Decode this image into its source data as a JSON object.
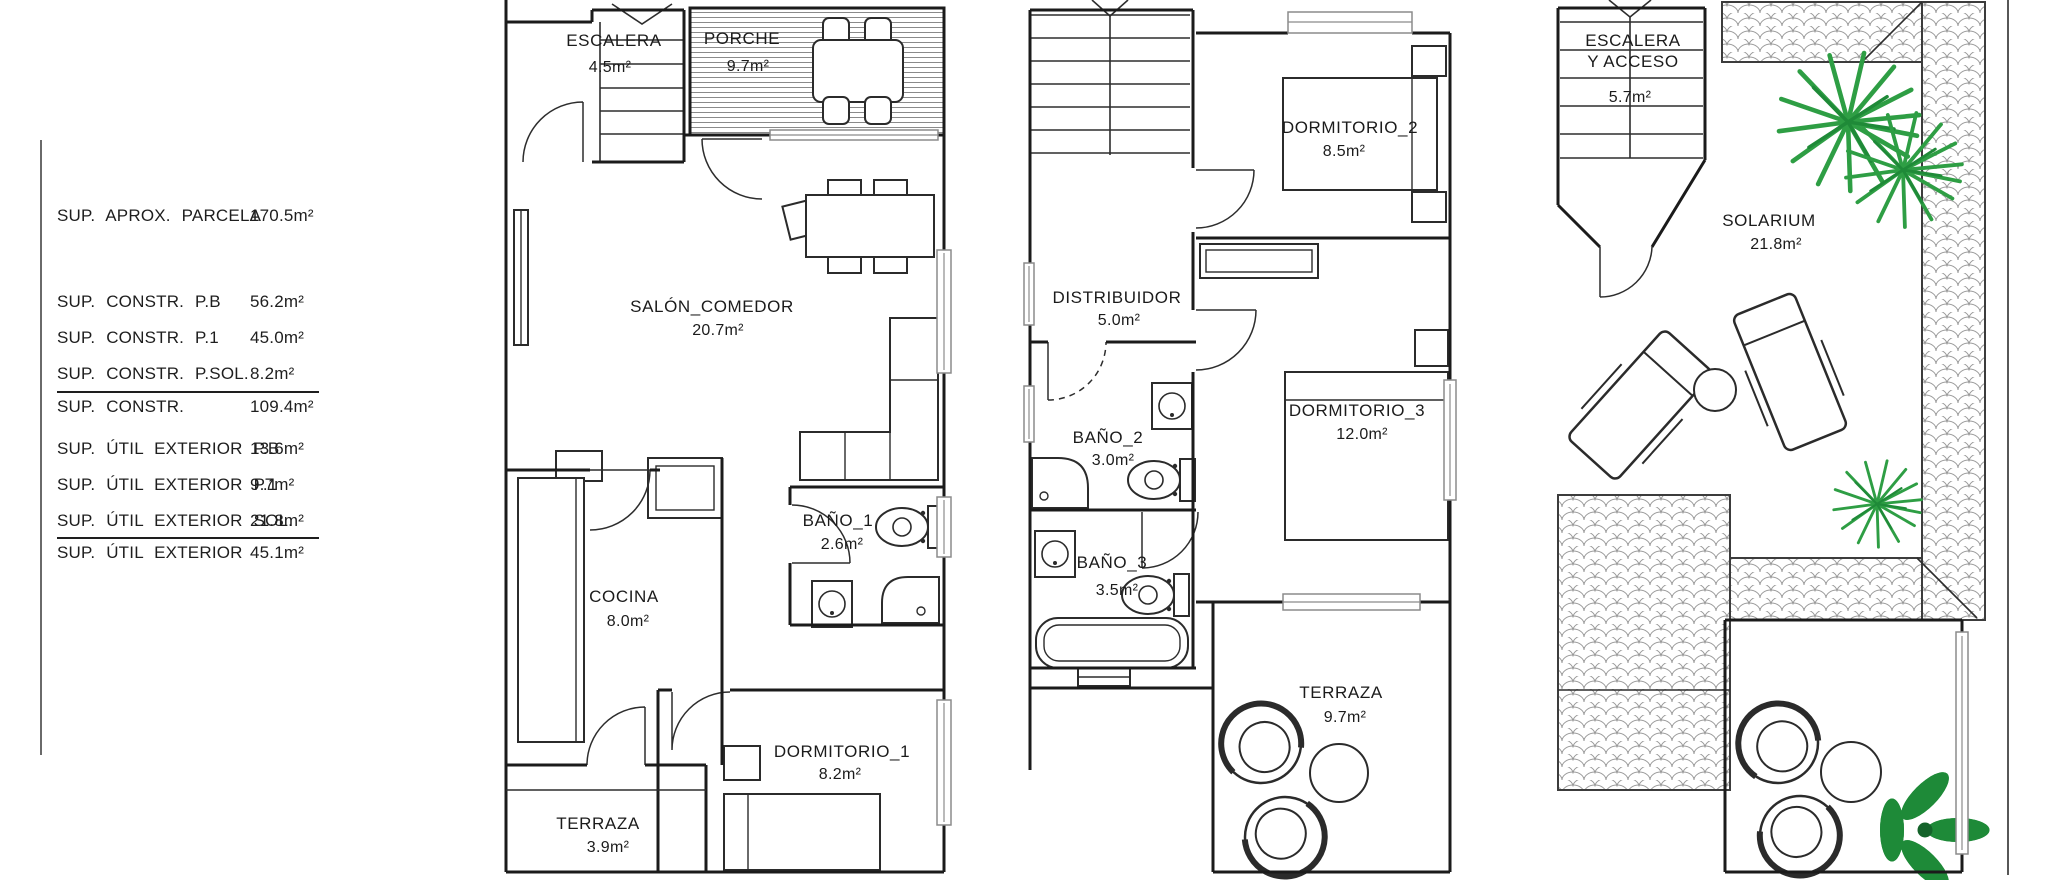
{
  "summary": {
    "parcela": {
      "label": "SUP. APROX. PARCELA",
      "value": "170.5m²"
    },
    "constr": [
      {
        "label": "SUP. CONSTR. P.B",
        "value": "56.2m²"
      },
      {
        "label": "SUP. CONSTR. P.1",
        "value": "45.0m²"
      },
      {
        "label": "SUP. CONSTR. P.SOL.",
        "value": "8.2m²"
      }
    ],
    "constr_total": {
      "label": "SUP. CONSTR.",
      "value": "109.4m²"
    },
    "util": [
      {
        "label": "SUP. ÚTIL EXTERIOR P.B",
        "value": "13.6m²"
      },
      {
        "label": "SUP. ÚTIL EXTERIOR P.1",
        "value": "9.7m²"
      },
      {
        "label": "SUP. ÚTIL EXTERIOR SOL.",
        "value": "21.8m²"
      }
    ],
    "util_total": {
      "label": "SUP. ÚTIL EXTERIOR",
      "value": "45.1m²"
    }
  },
  "ground_floor": {
    "escalera": {
      "name": "ESCALERA",
      "area": "4.5m²"
    },
    "porche": {
      "name": "PORCHE",
      "area": "9.7m²"
    },
    "salon": {
      "name": "SALÓN_COMEDOR",
      "area": "20.7m²"
    },
    "cocina": {
      "name": "COCINA",
      "area": "8.0m²"
    },
    "bano1": {
      "name": "BAÑO_1",
      "area": "2.6m²"
    },
    "dormitorio1": {
      "name": "DORMITORIO_1",
      "area": "8.2m²"
    },
    "terraza": {
      "name": "TERRAZA",
      "area": "3.9m²"
    }
  },
  "first_floor": {
    "dormitorio2": {
      "name": "DORMITORIO_2",
      "area": "8.5m²"
    },
    "distribuidor": {
      "name": "DISTRIBUIDOR",
      "area": "5.0m²"
    },
    "bano2": {
      "name": "BAÑO_2",
      "area": "3.0m²"
    },
    "dormitorio3": {
      "name": "DORMITORIO_3",
      "area": "12.0m²"
    },
    "bano3": {
      "name": "BAÑO_3",
      "area": "3.5m²"
    },
    "terraza": {
      "name": "TERRAZA",
      "area": "9.7m²"
    }
  },
  "solarium_floor": {
    "escalera_acceso": {
      "name_line1": "ESCALERA",
      "name_line2": "Y ACCESO",
      "area": "5.7m²"
    },
    "solarium": {
      "name": "SOLARIUM",
      "area": "21.8m²"
    }
  },
  "colors": {
    "wall": "#1b1b1b",
    "palm_green": "#2e9e44",
    "plant_green": "#1e8a38",
    "tile_hatch": "#9a9a9a",
    "window_gray": "#8b8b8b"
  }
}
